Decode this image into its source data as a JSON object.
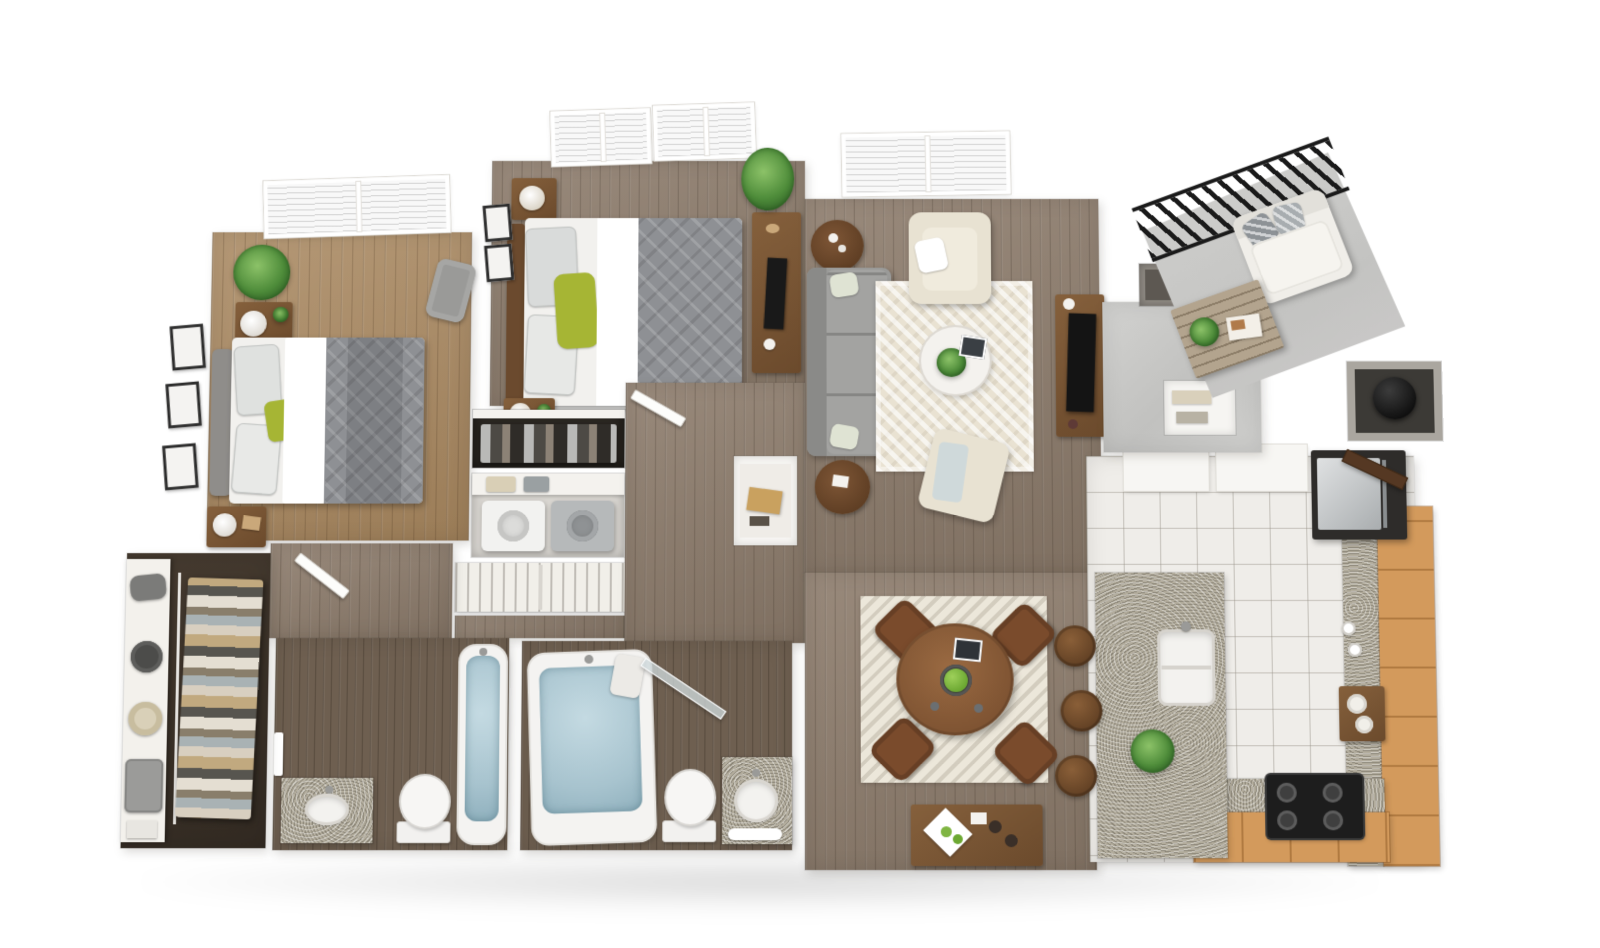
{
  "scene": {
    "type": "3d_floor_plan_render",
    "view": "top_down_isometric",
    "description": "Photorealistic dollhouse-style rendering of a two-bedroom, two-bathroom apartment with balcony",
    "visible_text": []
  },
  "palette": {
    "wallWhite": "#fbfaf8",
    "wallShade": "#e7e4df",
    "floorWarm": "#a8875f",
    "floorTaupe": "#8d7c6c",
    "floorBath": "#6e5f50",
    "floorCloset": "#3a3028",
    "tile": "#efede9",
    "tileLine": "#b9b5ac",
    "concrete": "#cbcbc9",
    "cabinetTan": "#d39a5c",
    "granite": "#b3ad9d",
    "woodFurn": "#7b5636",
    "woodFurnDark": "#5f4128",
    "sofaGray": "#9a9a98",
    "bedGray": "#8e9094",
    "accentGreen": "#a6b534",
    "plantGreen": "#4e8c3a",
    "waterBlue": "#a7c3ce",
    "railBlack": "#1a1a1a",
    "cream": "#e9e2d2",
    "appliance": "#c9cccd",
    "dark": "#2a2a2a"
  },
  "rooms": [
    {
      "id": "master-bedroom",
      "furniture": [
        "gray upholstered bed with patterned duvet",
        "green accent pillow",
        "two wood nightstands with lamps",
        "potted plant",
        "corner slipper chair",
        "three wall frames",
        "window with blinds"
      ]
    },
    {
      "id": "bedroom-2",
      "furniture": [
        "wood-frame bed with gray duvet",
        "green pillows",
        "two nightstands with basket lamps",
        "media desk with monitor",
        "tall plant",
        "two windows with blinds",
        "wall frames",
        "reach-in closet with suits"
      ]
    },
    {
      "id": "living-room",
      "furniture": [
        "gray three-seat sofa",
        "cream armchair",
        "cream accent chair with blue throw",
        "round white coffee table with plant",
        "two round wood side tables",
        "cream herringbone rug",
        "wood media console with flat TV",
        "window with blinds"
      ]
    },
    {
      "id": "dining-area",
      "furniture": [
        "round wood table",
        "four brown chairs",
        "bowl of green apples",
        "tablet",
        "patterned area rug",
        "wood sideboard with tray, apples and cups"
      ]
    },
    {
      "id": "kitchen",
      "furniture": [
        "granite island with double sink and plant",
        "three wood bar stools",
        "tan L-shaped cabinets with granite counters",
        "stainless refrigerator",
        "black four-burner cooktop",
        "white upper counters",
        "mugs",
        "wood tray with bowls",
        "white tile floor"
      ]
    },
    {
      "id": "bathroom-1",
      "furniture": [
        "soaking tub with water",
        "toilet",
        "granite vanity with oval sink",
        "towel bar",
        "door"
      ]
    },
    {
      "id": "bathroom-2",
      "furniture": [
        "large soaking tub with water",
        "toilet",
        "granite vanity with round sink",
        "glass panel door",
        "towels"
      ]
    },
    {
      "id": "walk-in-closet",
      "furniture": [
        "white shelving with duffel bag, hat boxes and suitcase",
        "hanging clothes on rail"
      ]
    },
    {
      "id": "laundry-closet",
      "furniture": [
        "washer",
        "dryer",
        "shelf with baskets"
      ]
    },
    {
      "id": "bedroom-2-closet",
      "furniture": [
        "hanging suits on rod",
        "shelf"
      ]
    },
    {
      "id": "linen-closet",
      "furniture": [
        "louvered bifold doors"
      ]
    },
    {
      "id": "hallway",
      "furniture": [
        "built-in niche with book",
        "interior doors"
      ]
    },
    {
      "id": "entry",
      "furniture": [
        "concrete floor",
        "coat closet",
        "pantry niche with shelves",
        "front door ajar"
      ]
    },
    {
      "id": "utility-closet",
      "furniture": [
        "black water heater"
      ]
    },
    {
      "id": "balcony",
      "furniture": [
        "black slat railing",
        "white outdoor loveseat with chevron pillows",
        "wood slat coffee table with plant and magazine",
        "concrete floor"
      ]
    }
  ]
}
